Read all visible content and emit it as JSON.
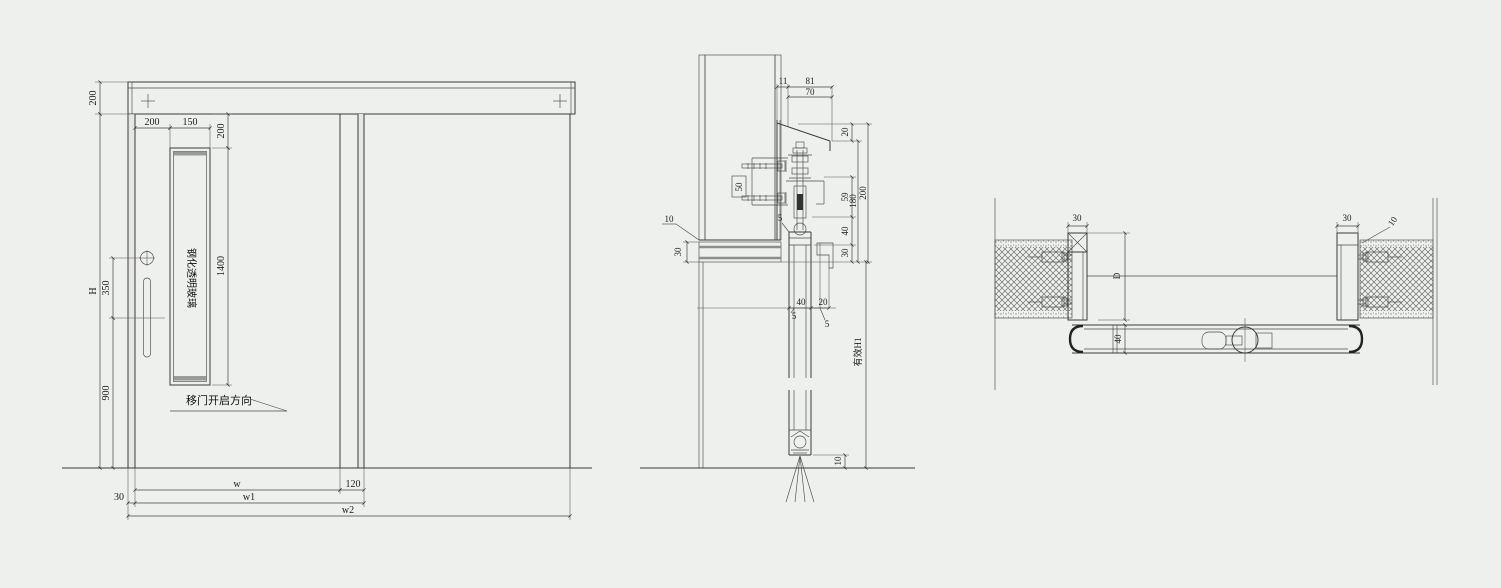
{
  "drawing": {
    "bg_color": "#eef0ed",
    "line_color": "#3a3a3a",
    "plus_mark": "+"
  },
  "elevation": {
    "glass_label": "钢化透明玻璃",
    "direction_label": "移门开启方向",
    "dims": {
      "header_height": "200",
      "total_height": "H",
      "handle_offset": "350",
      "handle_height": "900",
      "vision_left": "200",
      "vision_width": "150",
      "vision_top": "200",
      "vision_height": "1400",
      "clear_width": "w",
      "overlap": "120",
      "frame_offset": "30",
      "leaf_width": "w1",
      "overall_width": "w2"
    }
  },
  "section_vertical": {
    "dims": {
      "d11": "11",
      "d81": "81",
      "d70": "70",
      "d20_top": "20",
      "d59": "59",
      "d40_right": "40",
      "d30_right": "30",
      "d180": "180",
      "d200": "200",
      "d50_box": "50",
      "d10_wall": "10",
      "d30_sill": "30",
      "d5_top": "5",
      "d40_panel": "40",
      "d20_gap": "20",
      "d5_a": "5",
      "d5_b": "5",
      "d10_floor": "10",
      "effective_height": "有效H1"
    }
  },
  "section_plan": {
    "dims": {
      "post_left": "30",
      "post_right": "30",
      "gap_right": "10",
      "opening_depth": "D",
      "panel_thickness": "40"
    }
  }
}
